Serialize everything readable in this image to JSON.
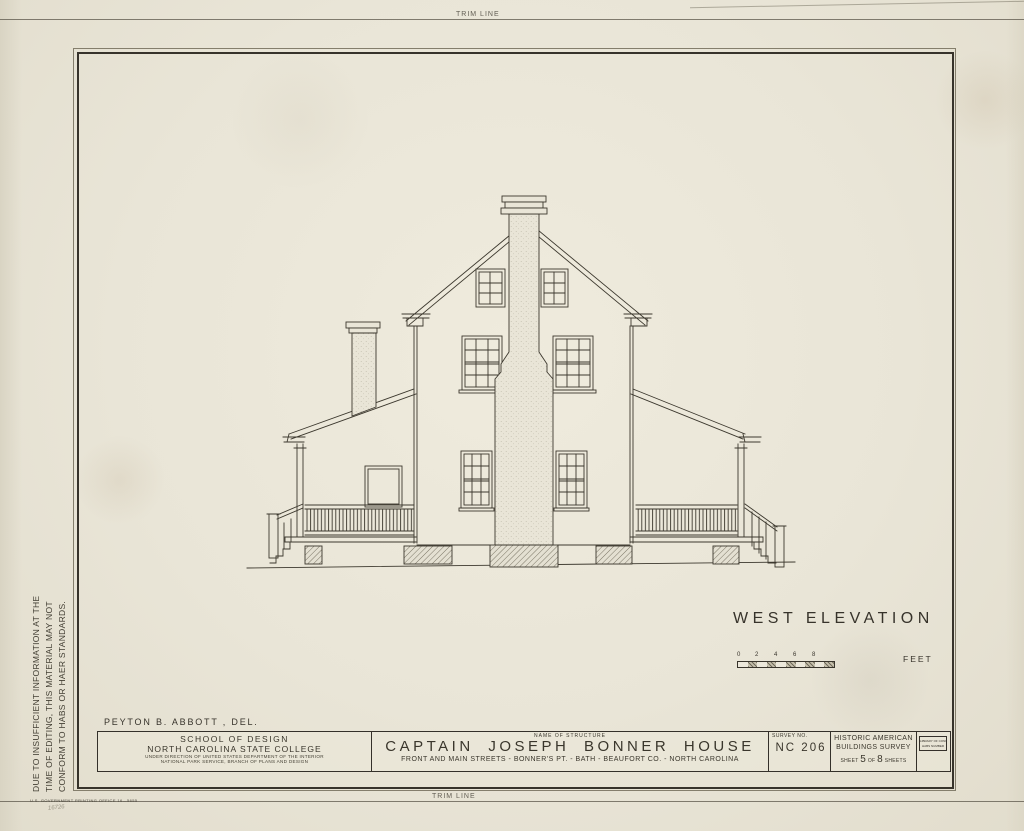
{
  "trim": {
    "top": "TRIM LINE",
    "bottom": "TRIM LINE"
  },
  "side_note": {
    "line1": "DUE TO INSUFFICIENT INFORMATION AT THE",
    "line2": "TIME OF EDITING, THIS MATERIAL MAY NOT",
    "line3": "CONFORM TO HABS OR HAER STANDARDS."
  },
  "drawing": {
    "label": "WEST ELEVATION",
    "scale": {
      "ticks": [
        "0",
        "2",
        "4",
        "6",
        "8"
      ],
      "unit": "FEET"
    }
  },
  "credits": {
    "delineator": "PEYTON B. ABBOTT , DEL."
  },
  "title_block": {
    "agency": {
      "line1": "SCHOOL OF DESIGN",
      "line2": "NORTH CAROLINA STATE COLLEGE",
      "line3": "UNDER DIRECTION OF UNITED STATES DEPARTMENT OF THE INTERIOR",
      "line4": "NATIONAL PARK SERVICE, BRANCH OF PLANS AND DESIGN"
    },
    "structure": {
      "header": "NAME OF STRUCTURE",
      "name": "CAPTAIN JOSEPH BONNER HOUSE",
      "address": "FRONT AND MAIN STREETS - BONNER'S PT. - BATH - BEAUFORT CO. - NORTH CAROLINA"
    },
    "survey": {
      "header": "SURVEY NO.",
      "number": "NC 206"
    },
    "habs": {
      "line1": "HISTORIC AMERICAN",
      "line2": "BUILDINGS SURVEY",
      "sheet_prefix": "SHEET",
      "sheet_number": "5",
      "of_word": "OF",
      "total": "8",
      "sheets_suffix": "SHEETS"
    },
    "stamp": {
      "line1": "LIBRARY OF CONGRESS",
      "line2": "HABS NUMBER"
    }
  },
  "footer": {
    "gpo": "U.S. GOVERNMENT PRINTING OFFICE    16—5655",
    "pencil_note": "16726"
  },
  "colors": {
    "ink": "#3c382e",
    "paper": "#e9e5d7"
  }
}
